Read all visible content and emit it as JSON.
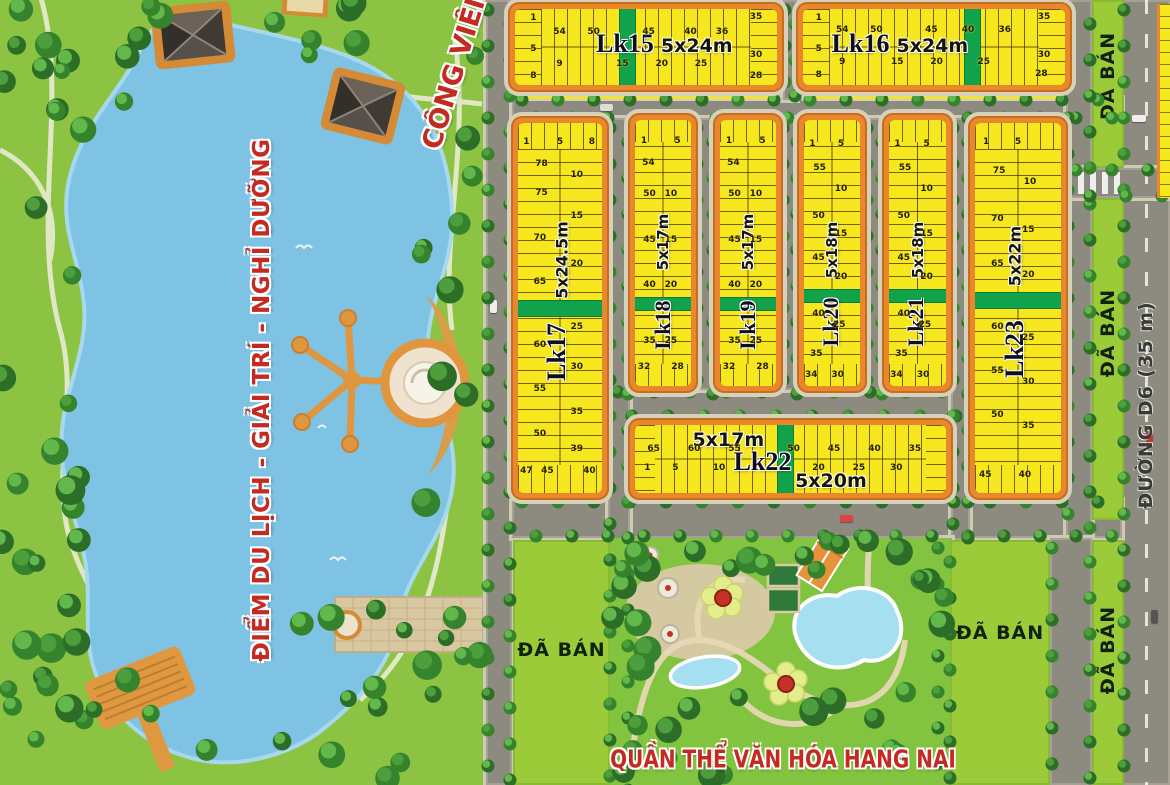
{
  "labels": {
    "lake_zone": "ĐIỂM DU LỊCH - GIẢI TRÍ - NGHỈ DƯỠNG",
    "park": "CÔNG VIÊN",
    "culture_complex": "QUẦN THỂ VĂN HÓA HANG NAI",
    "road_d6": "ĐƯỜNG D6 (35 m)",
    "sold": "ĐÃ BÁN"
  },
  "colors": {
    "lot_yellow": "#F6E71F",
    "block_orange": "#E8872B",
    "divider_green": "#12A24B",
    "park_green": "#8CC342",
    "sold_green": "#9CCB3A",
    "lake_blue": "#7EC3E4",
    "road_gray": "#8D8B80",
    "text_red": "#C42A21"
  },
  "blocks": [
    {
      "name": "Lk15",
      "size": "5x24m",
      "numbers": [
        {
          "t": "1",
          "x": 7,
          "y": 12
        },
        {
          "t": "54",
          "x": 17,
          "y": 30
        },
        {
          "t": "50",
          "x": 30,
          "y": 30
        },
        {
          "t": "45",
          "x": 51,
          "y": 30
        },
        {
          "t": "40",
          "x": 67,
          "y": 30
        },
        {
          "t": "36",
          "x": 79,
          "y": 30
        },
        {
          "t": "35",
          "x": 92,
          "y": 10
        },
        {
          "t": "5",
          "x": 7,
          "y": 52
        },
        {
          "t": "9",
          "x": 17,
          "y": 72
        },
        {
          "t": "15",
          "x": 41,
          "y": 72
        },
        {
          "t": "20",
          "x": 56,
          "y": 72
        },
        {
          "t": "25",
          "x": 71,
          "y": 72
        },
        {
          "t": "30",
          "x": 92,
          "y": 60
        },
        {
          "t": "8",
          "x": 7,
          "y": 88
        },
        {
          "t": "28",
          "x": 92,
          "y": 88
        }
      ]
    },
    {
      "name": "Lk16",
      "size": "5x24m",
      "numbers": [
        {
          "t": "1",
          "x": 6,
          "y": 12
        },
        {
          "t": "54",
          "x": 15,
          "y": 28
        },
        {
          "t": "50",
          "x": 28,
          "y": 28
        },
        {
          "t": "45",
          "x": 49,
          "y": 28
        },
        {
          "t": "40",
          "x": 63,
          "y": 28
        },
        {
          "t": "36",
          "x": 77,
          "y": 28
        },
        {
          "t": "35",
          "x": 92,
          "y": 10
        },
        {
          "t": "5",
          "x": 6,
          "y": 52
        },
        {
          "t": "9",
          "x": 15,
          "y": 70
        },
        {
          "t": "15",
          "x": 36,
          "y": 70
        },
        {
          "t": "20",
          "x": 51,
          "y": 70
        },
        {
          "t": "25",
          "x": 69,
          "y": 70
        },
        {
          "t": "30",
          "x": 92,
          "y": 60
        },
        {
          "t": "8",
          "x": 6,
          "y": 87
        },
        {
          "t": "28",
          "x": 91,
          "y": 85
        }
      ]
    },
    {
      "name": "Lk17",
      "size": "5x24.5m",
      "numbers": [
        {
          "t": "1",
          "x": 10,
          "y": 5
        },
        {
          "t": "5",
          "x": 50,
          "y": 5
        },
        {
          "t": "8",
          "x": 88,
          "y": 5
        },
        {
          "t": "78",
          "x": 28,
          "y": 11
        },
        {
          "t": "10",
          "x": 70,
          "y": 14
        },
        {
          "t": "75",
          "x": 28,
          "y": 19
        },
        {
          "t": "15",
          "x": 70,
          "y": 25
        },
        {
          "t": "70",
          "x": 26,
          "y": 31
        },
        {
          "t": "20",
          "x": 70,
          "y": 38
        },
        {
          "t": "65",
          "x": 26,
          "y": 43
        },
        {
          "t": "25",
          "x": 70,
          "y": 55
        },
        {
          "t": "60",
          "x": 26,
          "y": 60
        },
        {
          "t": "30",
          "x": 70,
          "y": 66
        },
        {
          "t": "55",
          "x": 26,
          "y": 72
        },
        {
          "t": "35",
          "x": 70,
          "y": 78
        },
        {
          "t": "50",
          "x": 26,
          "y": 84
        },
        {
          "t": "39",
          "x": 70,
          "y": 88
        },
        {
          "t": "47",
          "x": 10,
          "y": 94
        },
        {
          "t": "45",
          "x": 35,
          "y": 94
        },
        {
          "t": "40",
          "x": 85,
          "y": 94
        }
      ]
    },
    {
      "name": "Lk18",
      "size": "5x17m",
      "numbers": [
        {
          "t": "1",
          "x": 16,
          "y": 8
        },
        {
          "t": "5",
          "x": 76,
          "y": 8
        },
        {
          "t": "54",
          "x": 24,
          "y": 16
        },
        {
          "t": "50",
          "x": 26,
          "y": 28
        },
        {
          "t": "10",
          "x": 64,
          "y": 28
        },
        {
          "t": "45",
          "x": 26,
          "y": 45
        },
        {
          "t": "15",
          "x": 64,
          "y": 45
        },
        {
          "t": "40",
          "x": 26,
          "y": 62
        },
        {
          "t": "20",
          "x": 64,
          "y": 62
        },
        {
          "t": "35",
          "x": 26,
          "y": 83
        },
        {
          "t": "25",
          "x": 64,
          "y": 83
        },
        {
          "t": "32",
          "x": 16,
          "y": 93
        },
        {
          "t": "28",
          "x": 76,
          "y": 93
        }
      ]
    },
    {
      "name": "Lk19",
      "size": "5x17m",
      "numbers": [
        {
          "t": "1",
          "x": 16,
          "y": 8
        },
        {
          "t": "5",
          "x": 76,
          "y": 8
        },
        {
          "t": "54",
          "x": 24,
          "y": 16
        },
        {
          "t": "50",
          "x": 26,
          "y": 28
        },
        {
          "t": "10",
          "x": 64,
          "y": 28
        },
        {
          "t": "45",
          "x": 26,
          "y": 45
        },
        {
          "t": "15",
          "x": 64,
          "y": 45
        },
        {
          "t": "40",
          "x": 26,
          "y": 62
        },
        {
          "t": "20",
          "x": 64,
          "y": 62
        },
        {
          "t": "35",
          "x": 26,
          "y": 83
        },
        {
          "t": "25",
          "x": 64,
          "y": 83
        },
        {
          "t": "32",
          "x": 16,
          "y": 93
        },
        {
          "t": "28",
          "x": 76,
          "y": 93
        }
      ]
    },
    {
      "name": "Lk20",
      "size": "5x18m",
      "numbers": [
        {
          "t": "1",
          "x": 15,
          "y": 9
        },
        {
          "t": "5",
          "x": 66,
          "y": 9
        },
        {
          "t": "55",
          "x": 28,
          "y": 18
        },
        {
          "t": "10",
          "x": 66,
          "y": 26
        },
        {
          "t": "50",
          "x": 26,
          "y": 36
        },
        {
          "t": "15",
          "x": 66,
          "y": 43
        },
        {
          "t": "45",
          "x": 26,
          "y": 52
        },
        {
          "t": "20",
          "x": 66,
          "y": 59
        },
        {
          "t": "40",
          "x": 26,
          "y": 73
        },
        {
          "t": "25",
          "x": 63,
          "y": 77
        },
        {
          "t": "35",
          "x": 22,
          "y": 88
        },
        {
          "t": "34",
          "x": 13,
          "y": 96
        },
        {
          "t": "30",
          "x": 60,
          "y": 96
        }
      ]
    },
    {
      "name": "Lk21",
      "size": "5x18m",
      "numbers": [
        {
          "t": "1",
          "x": 15,
          "y": 9
        },
        {
          "t": "5",
          "x": 66,
          "y": 9
        },
        {
          "t": "55",
          "x": 28,
          "y": 18
        },
        {
          "t": "10",
          "x": 66,
          "y": 26
        },
        {
          "t": "50",
          "x": 26,
          "y": 36
        },
        {
          "t": "15",
          "x": 66,
          "y": 43
        },
        {
          "t": "45",
          "x": 26,
          "y": 52
        },
        {
          "t": "20",
          "x": 66,
          "y": 59
        },
        {
          "t": "40",
          "x": 26,
          "y": 73
        },
        {
          "t": "25",
          "x": 63,
          "y": 77
        },
        {
          "t": "35",
          "x": 22,
          "y": 88
        },
        {
          "t": "34",
          "x": 13,
          "y": 96
        },
        {
          "t": "30",
          "x": 60,
          "y": 96
        }
      ]
    },
    {
      "name": "Lk22",
      "size": "5x17m",
      "size2": "5x20m",
      "numbers": [
        {
          "t": "65",
          "x": 6,
          "y": 35
        },
        {
          "t": "60",
          "x": 19,
          "y": 35
        },
        {
          "t": "55",
          "x": 32,
          "y": 35
        },
        {
          "t": "50",
          "x": 51,
          "y": 35
        },
        {
          "t": "45",
          "x": 64,
          "y": 35
        },
        {
          "t": "40",
          "x": 77,
          "y": 35
        },
        {
          "t": "35",
          "x": 90,
          "y": 35
        },
        {
          "t": "1",
          "x": 4,
          "y": 63
        },
        {
          "t": "5",
          "x": 13,
          "y": 63
        },
        {
          "t": "10",
          "x": 27,
          "y": 63
        },
        {
          "t": "20",
          "x": 59,
          "y": 63
        },
        {
          "t": "25",
          "x": 72,
          "y": 63
        },
        {
          "t": "30",
          "x": 84,
          "y": 63
        }
      ]
    },
    {
      "name": "Lk23",
      "size": "5x22m",
      "numbers": [
        {
          "t": "1",
          "x": 13,
          "y": 5
        },
        {
          "t": "5",
          "x": 50,
          "y": 5
        },
        {
          "t": "75",
          "x": 28,
          "y": 13
        },
        {
          "t": "10",
          "x": 64,
          "y": 16
        },
        {
          "t": "70",
          "x": 26,
          "y": 26
        },
        {
          "t": "15",
          "x": 62,
          "y": 29
        },
        {
          "t": "65",
          "x": 26,
          "y": 38
        },
        {
          "t": "20",
          "x": 62,
          "y": 41
        },
        {
          "t": "60",
          "x": 26,
          "y": 55
        },
        {
          "t": "25",
          "x": 62,
          "y": 58
        },
        {
          "t": "55",
          "x": 26,
          "y": 67
        },
        {
          "t": "30",
          "x": 62,
          "y": 70
        },
        {
          "t": "50",
          "x": 26,
          "y": 79
        },
        {
          "t": "35",
          "x": 62,
          "y": 82
        },
        {
          "t": "45",
          "x": 12,
          "y": 95
        },
        {
          "t": "40",
          "x": 58,
          "y": 95
        }
      ]
    }
  ]
}
